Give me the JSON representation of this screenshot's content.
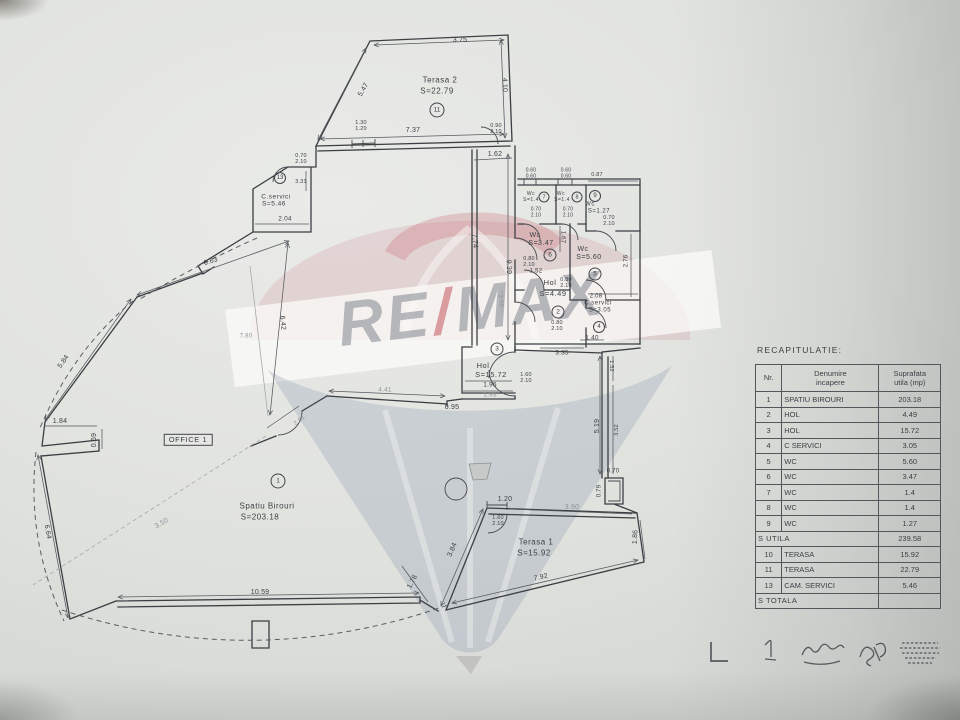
{
  "watermark": {
    "re": "RE",
    "slash": "/",
    "max": "MAX"
  },
  "rooms": {
    "spatiu": {
      "name": "Spatiu Birouri",
      "area": "S=203.18",
      "num": "1"
    },
    "hol2": {
      "name": "Hol",
      "area": "S=4.49",
      "num": "2"
    },
    "hol3": {
      "name": "Hol",
      "area": "S=15.72",
      "num": "3"
    },
    "cserv4": {
      "name": "C.servici",
      "area": "S=3.05",
      "num": "4"
    },
    "wc5": {
      "name": "Wc",
      "area": "S=5.60",
      "num": "5"
    },
    "wc6": {
      "name": "Wc",
      "area": "S=3.47",
      "num": "6"
    },
    "wc7": {
      "name": "Wc",
      "area": "S=1.4",
      "num": "7"
    },
    "wc8": {
      "name": "Wc",
      "area": "S=1.4",
      "num": "8"
    },
    "wc9": {
      "name": "Wc",
      "area": "S=1.27",
      "num": "9"
    },
    "terasa1": {
      "name": "Terasa 1",
      "area": "S=15.92"
    },
    "terasa2": {
      "name": "Terasa 2",
      "area": "S=22.79",
      "num": "11"
    },
    "cserv13": {
      "name": "C.servici",
      "area": "S=5.46",
      "num": "13"
    },
    "office_tag": "OFFICE 1"
  },
  "dims": {
    "t2_top": "3.75",
    "t2_diag": "5.47",
    "t2_right": "4.10",
    "t2_bottom": "7.37",
    "t2_win": "1.30\n1.20",
    "t2_door": "0.90\n2.10",
    "corr_gap": "1.62",
    "c13_door": "0.70\n2.10",
    "c13_v": "3.31",
    "c13_b": "2.04",
    "wc_win1": "0.60\n0.60",
    "wc_win2": "0.60\n0.60",
    "wc9_top": "0.87",
    "wc7_door": "0.70\n2.10",
    "wc8_door": "0.70\n2.10",
    "wc9_door": "0.70\n2.10",
    "wc6_h": "1.67",
    "wc6_door": "0.80\n2.10",
    "hol2_w": "1.52",
    "wc5_door": "0.80\n2.10",
    "c4_door": "0.80\n2.10",
    "wc5_v": "2.76",
    "c4_top": "2.08",
    "hol2_bw": "1.40",
    "open_w": "3.35",
    "corr_v": "9.39",
    "corr_wall": "7.74",
    "corr_w": "2.55",
    "hol3_b1": "1.96",
    "hol3_b2": "1.93",
    "hol3_door": "1.60\n2.10",
    "step": "0.95",
    "off_top": "4.41",
    "entry_diag": "2.51",
    "rw_v1": "1.52",
    "rw_v2": "5.19",
    "rw_v3": "3.52",
    "col_w": "0.70",
    "col_h": "0.79",
    "t1_tick": "1.20",
    "t1_door": "1.60\n2.10",
    "t1_top": "3.90",
    "t1_right": "1.86",
    "t1_bottom": "7.92",
    "t1_diag": "3.84",
    "t1_ldiag": "1.78",
    "left1": "6.63",
    "left2": "5.84",
    "left3": "1.84",
    "left4": "0.59",
    "left5": "6.64",
    "left6": "6.42",
    "left7": "7.80",
    "bottom": "10.59",
    "faint_diag": "3.50"
  },
  "table": {
    "title": "RECAPITULATIE:",
    "headers": {
      "nr": "Nr.",
      "name": "Denumire\nincapere",
      "area": "Suprafata\nutila (mp)"
    },
    "rows": [
      {
        "nr": "1",
        "name": "SPATIU BIROURI",
        "val": "203.18"
      },
      {
        "nr": "2",
        "name": "HOL",
        "val": "4.49"
      },
      {
        "nr": "3",
        "name": "HOL",
        "val": "15.72"
      },
      {
        "nr": "4",
        "name": "C SERVICI",
        "val": "3.05"
      },
      {
        "nr": "5",
        "name": "WC",
        "val": "5.60"
      },
      {
        "nr": "6",
        "name": "WC",
        "val": "3.47"
      },
      {
        "nr": "7",
        "name": "WC",
        "val": "1.4"
      },
      {
        "nr": "8",
        "name": "WC",
        "val": "1.4"
      },
      {
        "nr": "9",
        "name": "WC",
        "val": "1.27"
      },
      {
        "nr": "10",
        "name": "TERASA",
        "val": "15.92"
      },
      {
        "nr": "11",
        "name": "TERASA",
        "val": "22.79"
      },
      {
        "nr": "13",
        "name": "CAM. SERVICI",
        "val": "5.46"
      }
    ],
    "sutila": {
      "label": "S UTILA",
      "val": "239.58"
    },
    "stotala": {
      "label": "S TOTALA",
      "val": ""
    }
  }
}
